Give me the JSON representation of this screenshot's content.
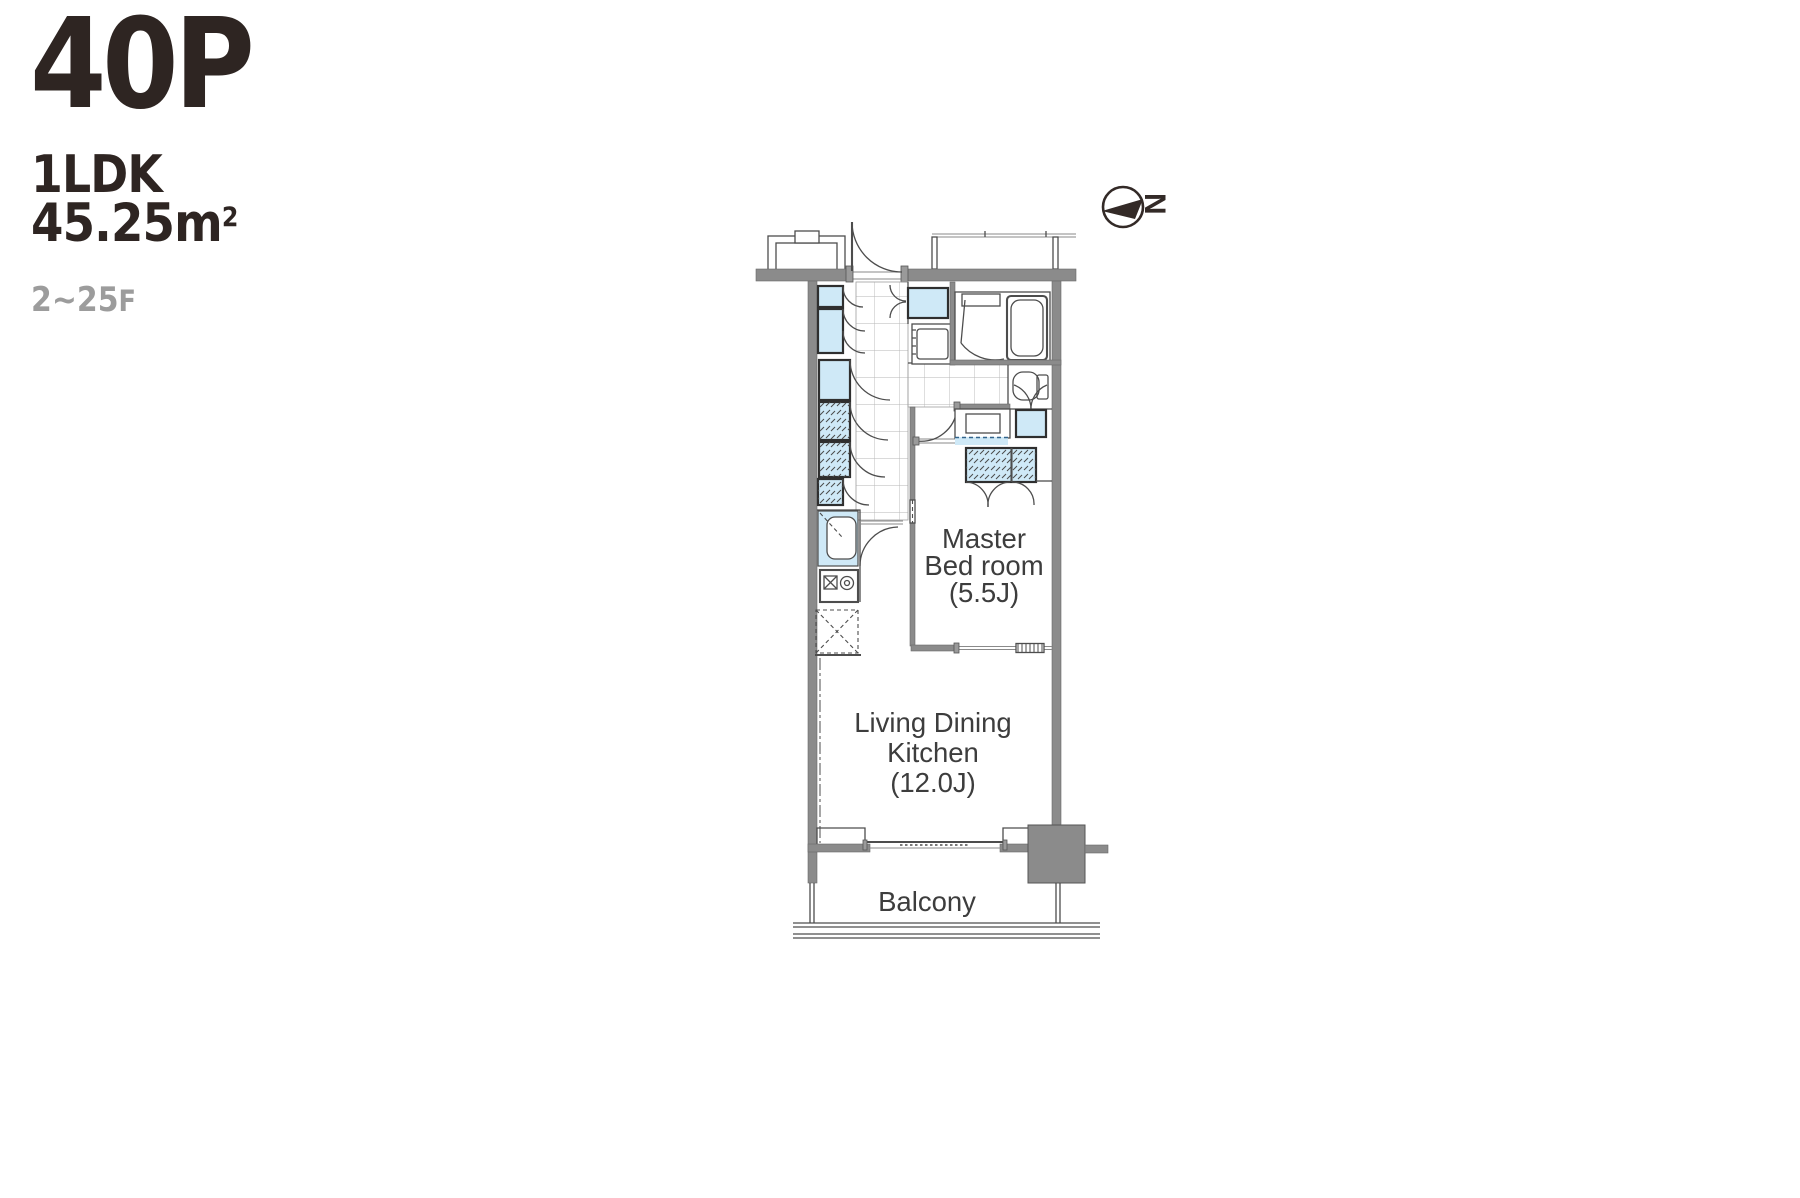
{
  "header": {
    "plan_code": "40P",
    "layout_type": "1LDK",
    "area": "45.25m",
    "area_sup": "2",
    "floor_range": "2~25",
    "floor_suffix": "F"
  },
  "plan": {
    "bedroom_label": [
      "Master",
      "Bed room",
      "(5.5J)"
    ],
    "ldk_label": [
      "Living Dining",
      "Kitchen",
      "(12.0J)"
    ],
    "balcony_label": "Balcony",
    "compass_n": "N"
  },
  "colors": {
    "title_text": "#2e2522",
    "floor_range_gray": "#9c9c9c",
    "fixture_blue": "#cfe9f7",
    "wall_gray": "#8b8b8b",
    "plan_line": "#4d4d4d",
    "label_text": "#3d3d3d"
  }
}
